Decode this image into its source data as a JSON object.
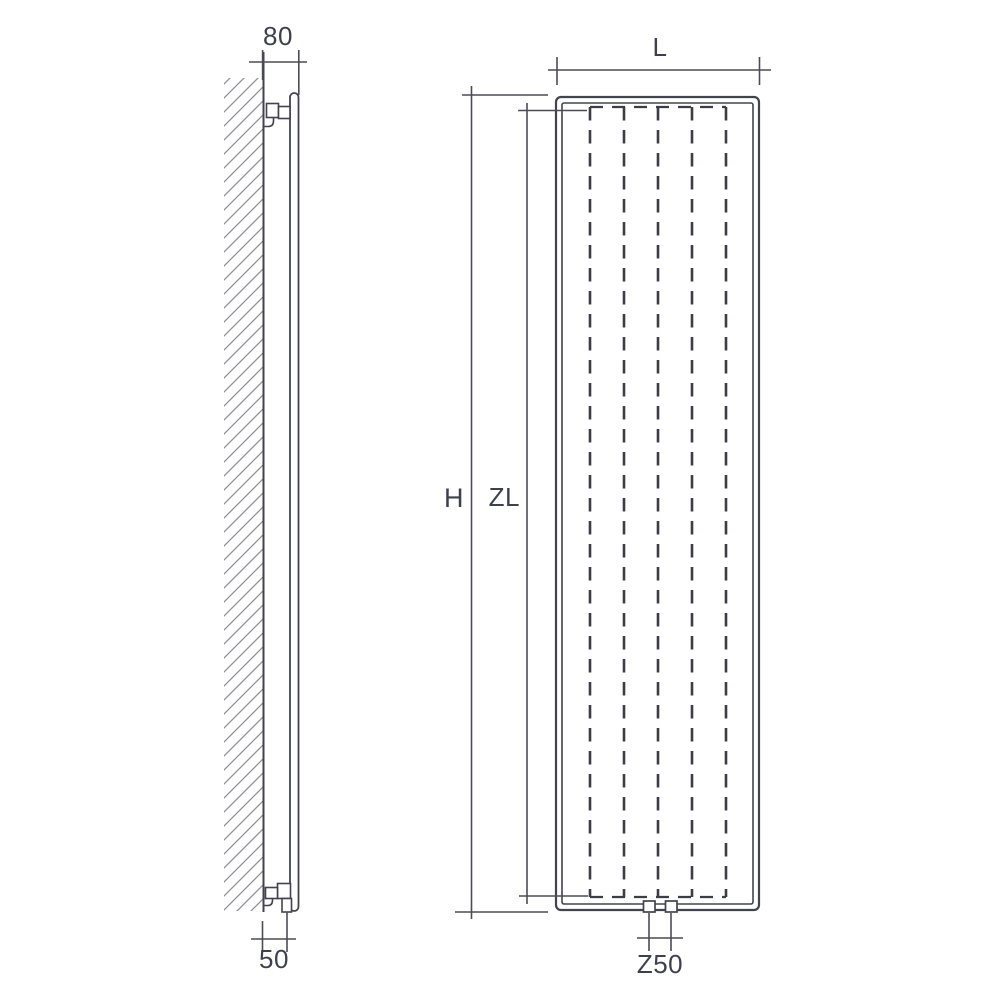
{
  "drawing": {
    "side_view": {
      "dim_top": "80",
      "dim_bottom": "50"
    },
    "front_view": {
      "dim_width": "L",
      "dim_height": "H",
      "dim_inner_height": "ZL",
      "dim_connection": "Z50"
    },
    "colors": {
      "line": "#42434e",
      "text": "#3f404e",
      "hatch": "#90909a",
      "background": "#ffffff"
    }
  }
}
